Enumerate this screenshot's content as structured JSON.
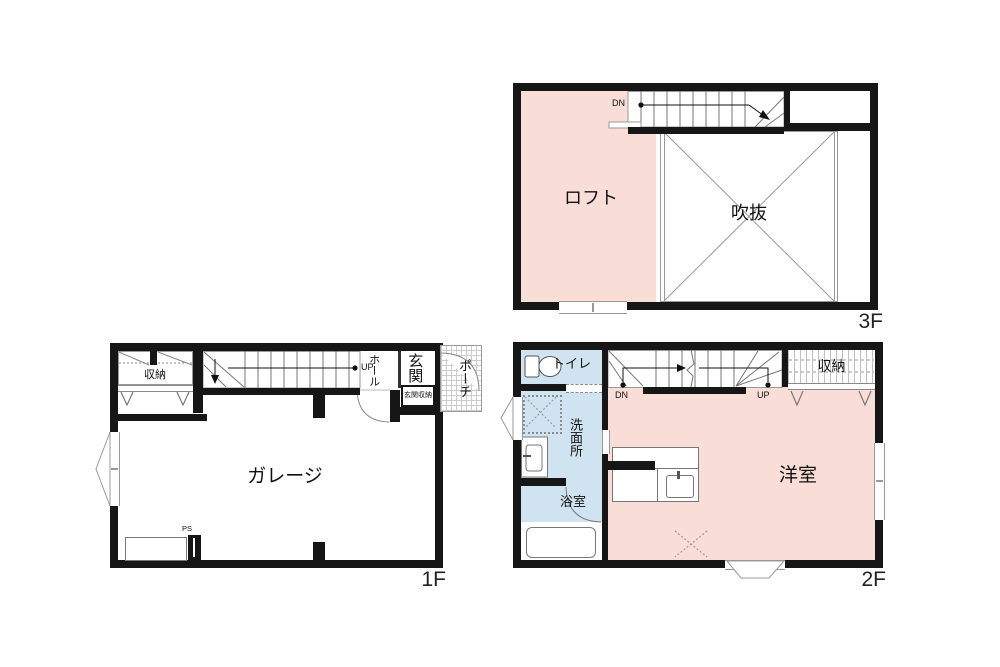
{
  "colors": {
    "wall": "#161616",
    "room_pink": "#f9ded7",
    "room_blue": "#cfe4f0"
  },
  "floor3": {
    "label": "3F",
    "rooms": {
      "loft": "ロフト",
      "void": "吹抜"
    },
    "stair": {
      "dn": "DN"
    }
  },
  "floor1": {
    "label": "1F",
    "rooms": {
      "storage": "収納",
      "hall": "ホール",
      "entrance": "玄関",
      "entrance_storage": "玄関収納",
      "porch": "ポーチ",
      "garage": "ガレージ"
    },
    "stair": {
      "up": "UP"
    },
    "ps": "PS"
  },
  "floor2": {
    "label": "2F",
    "rooms": {
      "toilet": "トイレ",
      "washroom": "洗面所",
      "bathroom": "浴室",
      "storage": "収納",
      "western_room": "洋室"
    },
    "stair": {
      "dn": "DN",
      "up": "UP"
    }
  }
}
